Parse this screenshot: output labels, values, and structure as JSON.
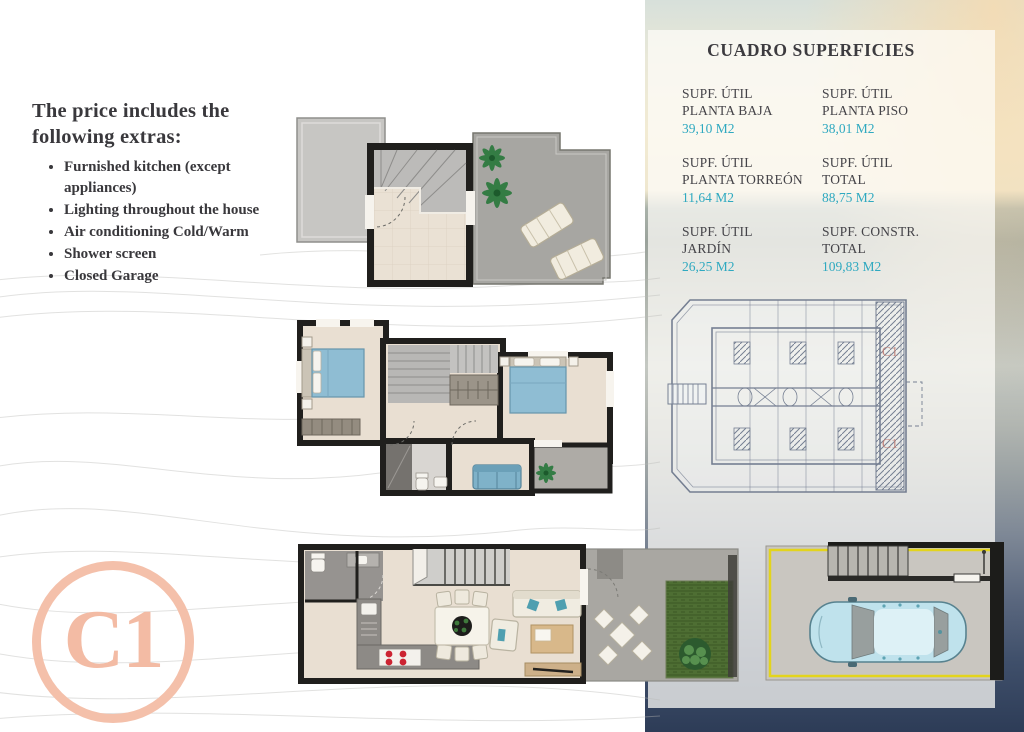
{
  "intro": {
    "heading": "The price includes the following extras:",
    "items": [
      "Furnished kitchen (except appliances)",
      "Lighting throughout the house",
      "Air conditioning Cold/Warm",
      "Shower screen",
      "Closed Garage"
    ]
  },
  "surfaces": {
    "title": "CUADRO SUPERFICIES",
    "cells": [
      {
        "line1": "SUPF. ÚTIL",
        "line2": "PLANTA BAJA",
        "value": "39,10 M2"
      },
      {
        "line1": "SUPF. ÚTIL",
        "line2": "PLANTA PISO",
        "value": "38,01 M2"
      },
      {
        "line1": "SUPF. ÚTIL",
        "line2": "PLANTA TORREÓN",
        "value": "11,64 M2"
      },
      {
        "line1": "SUPF. ÚTIL",
        "line2": "TOTAL",
        "value": "88,75 M2"
      },
      {
        "line1": "SUPF. ÚTIL",
        "line2": "JARDÍN",
        "value": "26,25 M2"
      },
      {
        "line1": "SUPF. CONSTR.",
        "line2": "TOTAL",
        "value": "109,83 M2"
      }
    ]
  },
  "unit_badge": "C1",
  "site_plan": {
    "unit_label_top": "C1",
    "unit_label_bottom": "C1"
  },
  "colors": {
    "accent_cyan": "#2fa9c0",
    "text_dark": "#3c3b3f",
    "logo_salmon": "#f3bba4",
    "garage_outline": "#e3d41c",
    "siteplan_red": "#b4655c",
    "bed_blue": "#8fbdd3",
    "car_blue": "#bfe2ec"
  }
}
